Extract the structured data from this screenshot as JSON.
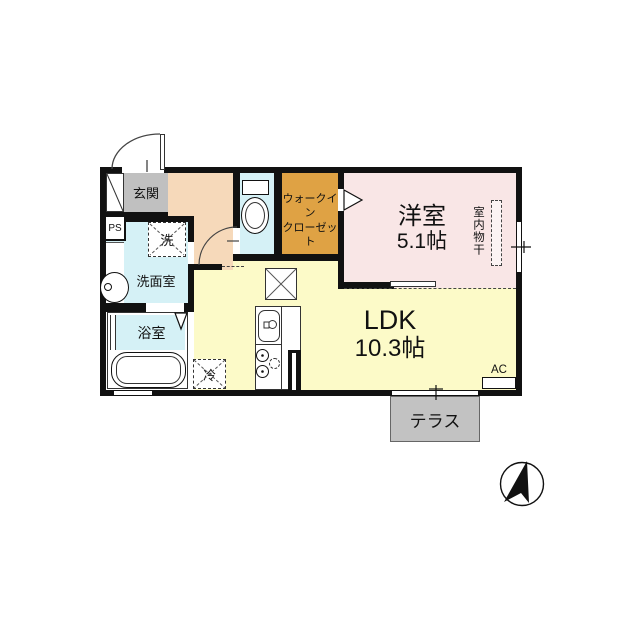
{
  "floorplan": {
    "wall_color": "#111111",
    "rooms": {
      "genkan": {
        "label": "玄関",
        "color": "#C0C0C0"
      },
      "ps_shaft": {
        "label": "PS",
        "color": "#FFFFFF"
      },
      "washroom": {
        "label": "洗面室",
        "color": "#D5F1F6"
      },
      "washing_machine": {
        "label": "洗"
      },
      "bathroom": {
        "label": "浴室",
        "color": "#D5F1F6"
      },
      "toilet": {
        "color": "#D5F1F6"
      },
      "hallway": {
        "color": "#F6D9BA"
      },
      "walk_in_closet": {
        "label_line1": "ウォークイン",
        "label_line2": "クローゼット",
        "color": "#DFA244"
      },
      "western_room": {
        "label": "洋室",
        "size": "5.1帖",
        "color": "#F9E6E6",
        "indoor_drying_label": "室内物干"
      },
      "ldk": {
        "label": "LDK",
        "size": "10.3帖",
        "color": "#FCFAC8"
      },
      "refrigerator": {
        "label": "冷"
      },
      "air_conditioner": {
        "label": "AC"
      },
      "terrace": {
        "label": "テラス",
        "color": "#C2C2C2"
      }
    }
  }
}
